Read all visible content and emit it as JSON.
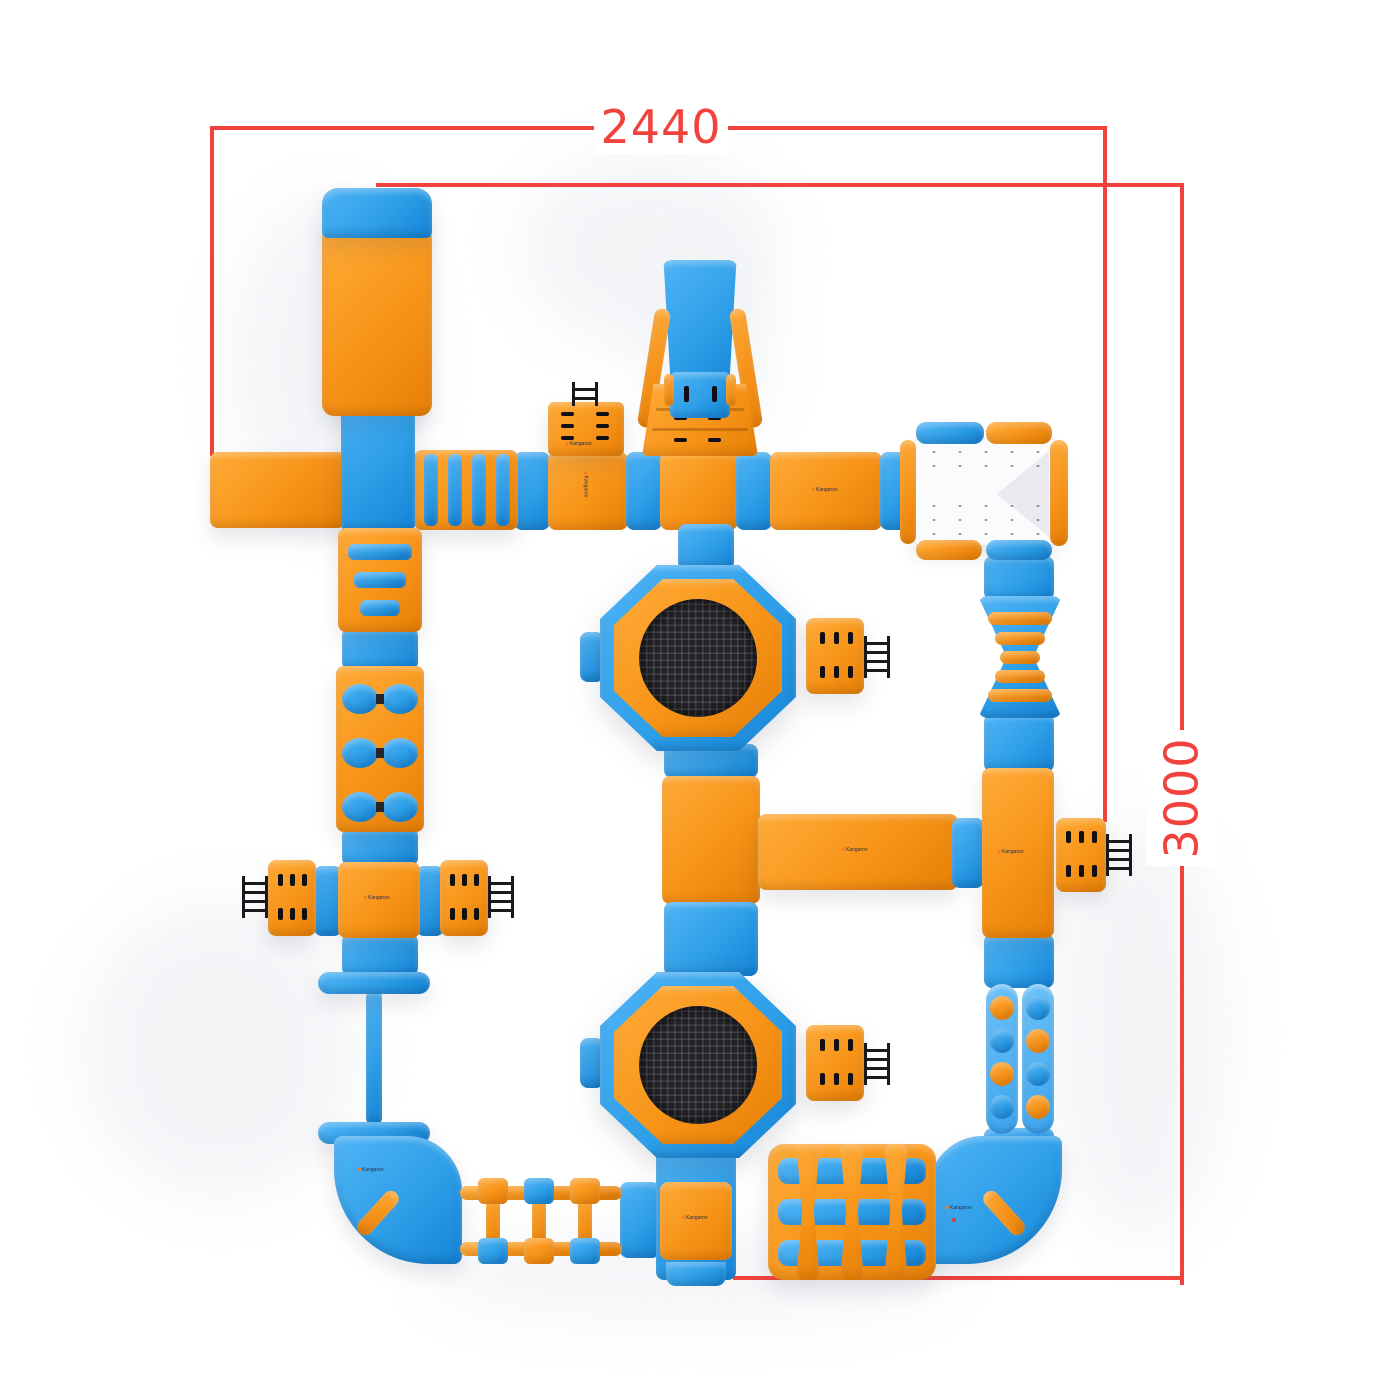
{
  "dimensions": {
    "width_label": "2440",
    "height_label": "3000"
  },
  "brand": {
    "logo_text": "Kangaroo"
  },
  "colors": {
    "orange": "#F7941E",
    "blue": "#2E9FE8",
    "dimension_red": "#F2423E",
    "trampoline_mesh": "#232327",
    "platform_white": "#FBFBFD",
    "background": "#FFFFFF"
  },
  "icons": {
    "ladder": "ladder-icon",
    "climb_grips": "grip-dash-icon",
    "handle": "handle-pill-icon",
    "trampoline": "trampoline-mesh"
  }
}
